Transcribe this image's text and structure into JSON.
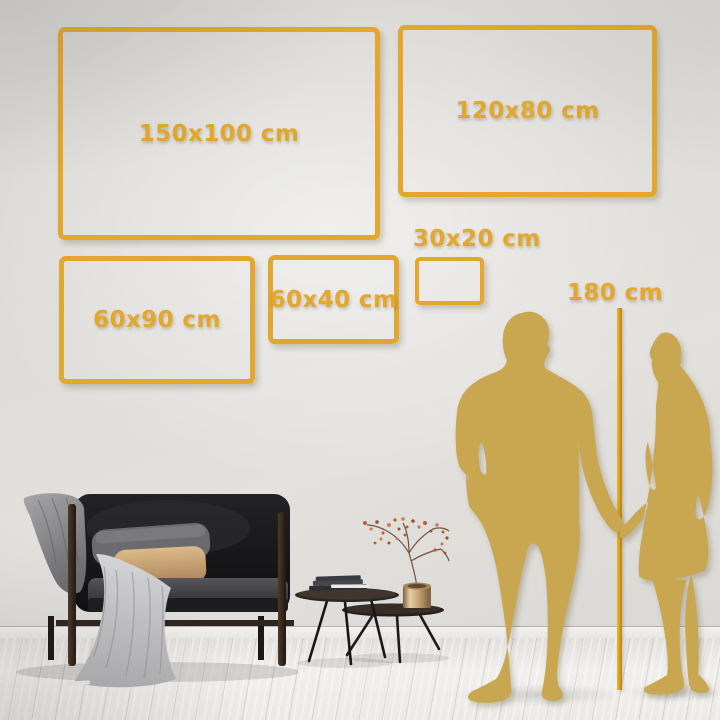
{
  "size_guide": {
    "unit": "cm",
    "frame_sizes": [
      {
        "id": "150x100",
        "label": "150x100 cm",
        "width_cm": 150,
        "height_cm": 100
      },
      {
        "id": "120x80",
        "label": "120x80 cm",
        "width_cm": 120,
        "height_cm": 80
      },
      {
        "id": "60x90",
        "label": "60x90 cm",
        "width_cm": 60,
        "height_cm": 90
      },
      {
        "id": "60x40",
        "label": "60x40 cm",
        "width_cm": 60,
        "height_cm": 40
      },
      {
        "id": "30x20",
        "label": "30x20 cm",
        "width_cm": 30,
        "height_cm": 20
      }
    ],
    "height_reference": {
      "label": "180 cm",
      "value_cm": 180
    }
  },
  "colors": {
    "accent_gold": "#E2A72C",
    "line_gold": "#D49A12",
    "silhouette_gold": "#C9A750",
    "wall": "#DEDCD9",
    "floor": "#EDECE9"
  }
}
